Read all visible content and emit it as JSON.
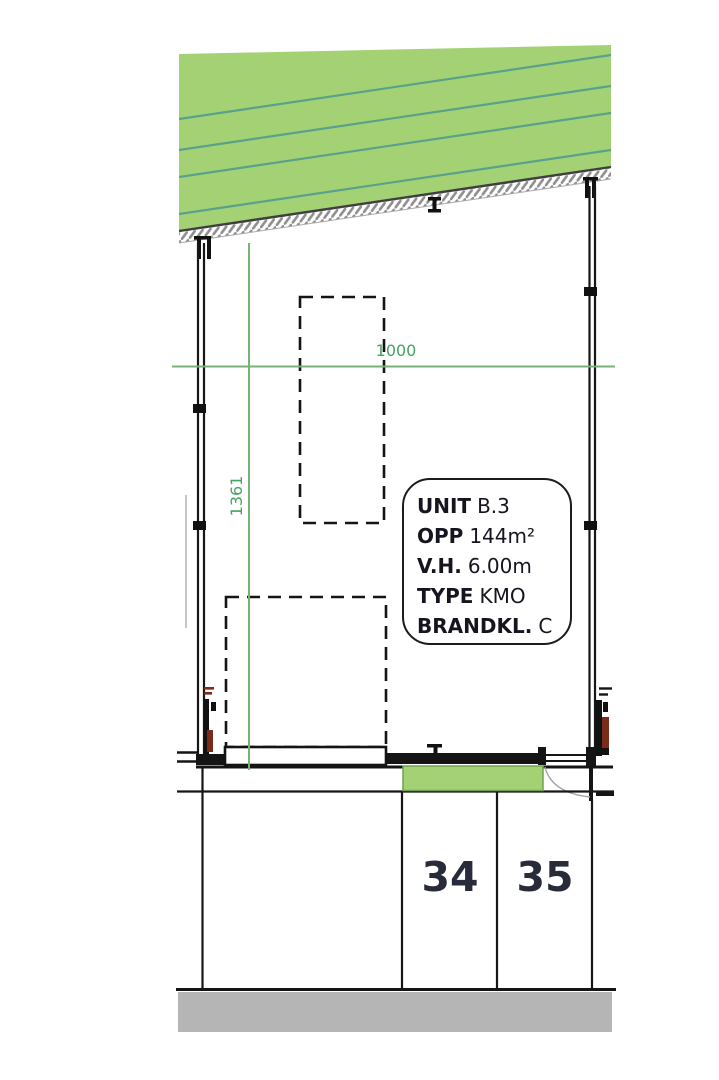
{
  "dimensions": {
    "horizontal": "1000",
    "vertical": "1361"
  },
  "unit_info": {
    "rows": [
      {
        "label": "UNIT",
        "value": "B.3"
      },
      {
        "label": "OPP",
        "value": "144m²"
      },
      {
        "label": "V.H.",
        "value": "6.00m"
      },
      {
        "label": "TYPE",
        "value": "KMO"
      },
      {
        "label": "BRANDKL.",
        "value": "C"
      }
    ]
  },
  "parking": {
    "spaces": [
      {
        "number": "34"
      },
      {
        "number": "35"
      }
    ]
  },
  "colors": {
    "grass_green": "#a4d173",
    "dimension_green_line": "#79b277",
    "dimension_green_text": "#49a163",
    "road_gray": "#b5b5b5",
    "wall_black": "#161616",
    "detail_brown": "#7a2c1c",
    "hatch_teal": "#58a28b"
  }
}
